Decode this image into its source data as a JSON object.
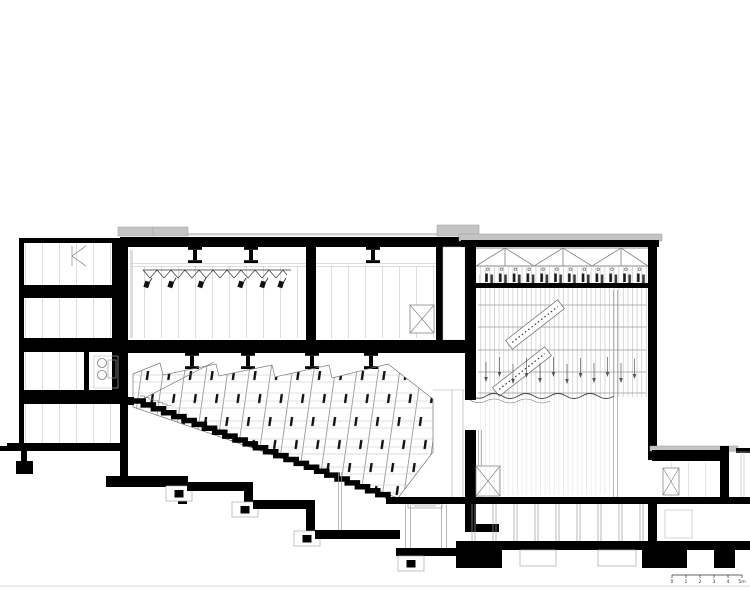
{
  "drawing": {
    "kind": "architectural-building-section",
    "colors": {
      "ink": "#000000",
      "background": "#ffffff",
      "roof_fill": "#c4c4c4",
      "light_line": "#c9c9c9",
      "mid_line": "#8a8a8a"
    }
  },
  "scale_bar": {
    "labels": [
      "0",
      "1",
      "2",
      "3",
      "4",
      "5m"
    ]
  }
}
